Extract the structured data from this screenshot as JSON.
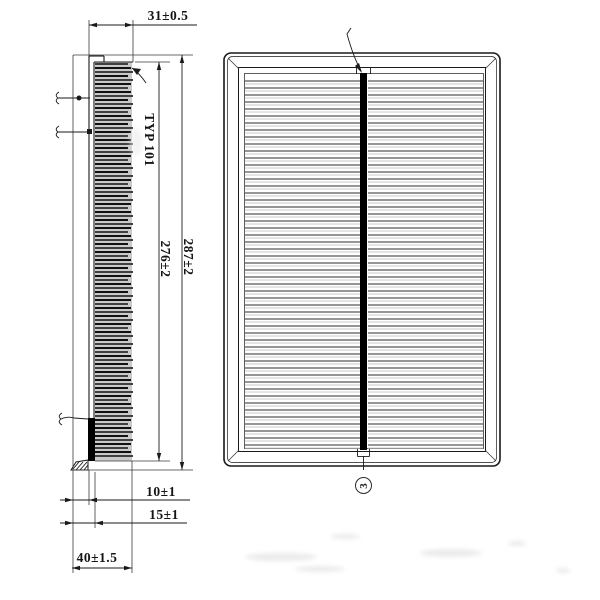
{
  "drawing": {
    "side_view": {
      "width_dim": "31±0.5",
      "pleat_note": "TYP 101",
      "media_height_dim": "276±2",
      "overall_height_dim": "287±2",
      "foot_dim": "10±1",
      "seal_dim": "15±1",
      "depth_dim": "40±1.5"
    },
    "front_view": {
      "balloon": "3"
    },
    "colors": {
      "line": "#1a1a1a",
      "thin_line": "#3a3a3a",
      "media_fill": "#cacaca",
      "pleat_dark": "#111111",
      "pleat_mid": "#404040",
      "front_pleat_dark": "#2e2e2e",
      "front_pleat_light": "#c8c8c8",
      "seam_bar": "#000000",
      "background": "#ffffff"
    }
  }
}
